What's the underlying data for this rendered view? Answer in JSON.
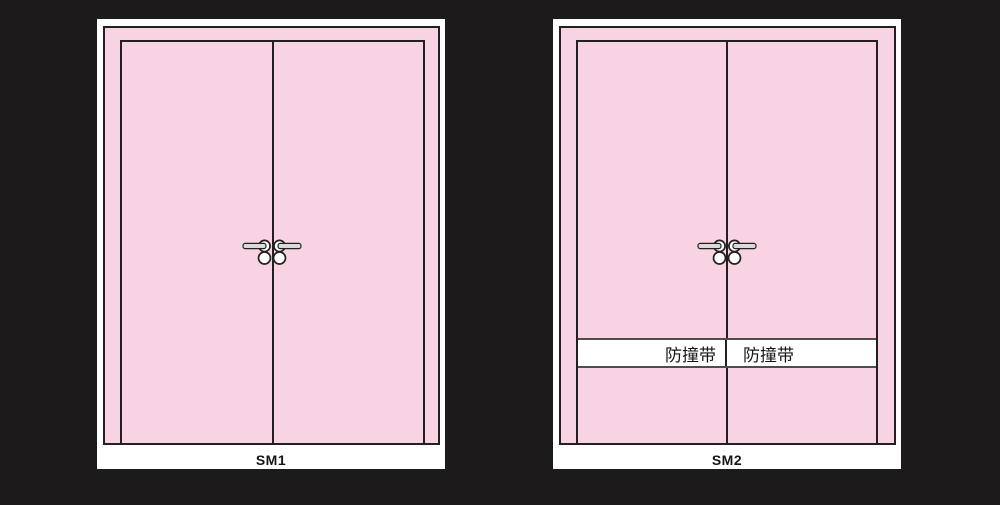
{
  "colors": {
    "background": "#1C1A1A",
    "panel_white": "#FFFFFF",
    "door_pink": "#F8D3E3",
    "outline": "#241F21",
    "band_line": "#4D4D4D",
    "handle_metal": "#D9D9D9",
    "text": "#151515"
  },
  "units": [
    {
      "label": "SM1"
    },
    {
      "label": "SM2",
      "band": {
        "left_text": "防撞带",
        "right_text": "防撞带"
      }
    }
  ],
  "icons": {
    "handle": "door-lever-handle-icon",
    "lock": "lock-cylinder-icon"
  }
}
